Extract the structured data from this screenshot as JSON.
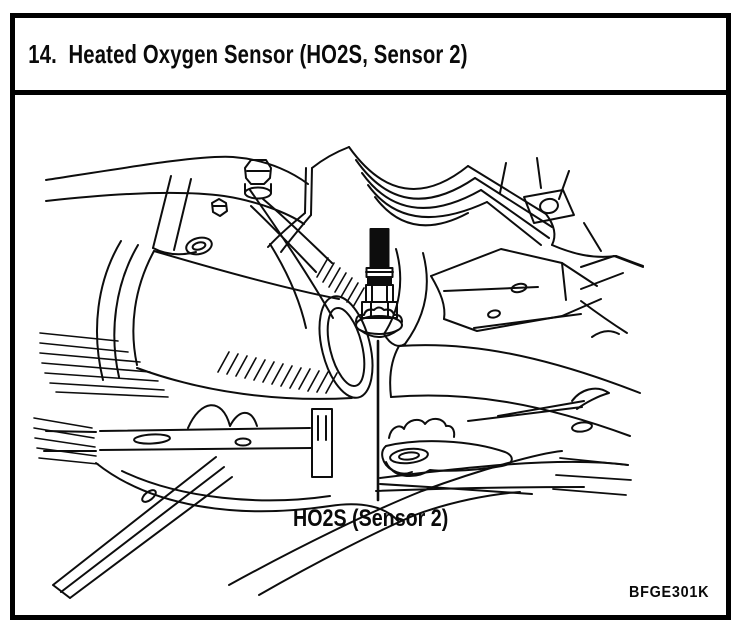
{
  "title_bar": {
    "title": "14.  Heated Oxygen Sensor (HO2S, Sensor 2)"
  },
  "figure": {
    "part_label": "HO2S (Sensor 2)",
    "figure_code": "BFGE301K"
  },
  "colors": {
    "ink": "#000000",
    "paper": "#ffffff"
  }
}
